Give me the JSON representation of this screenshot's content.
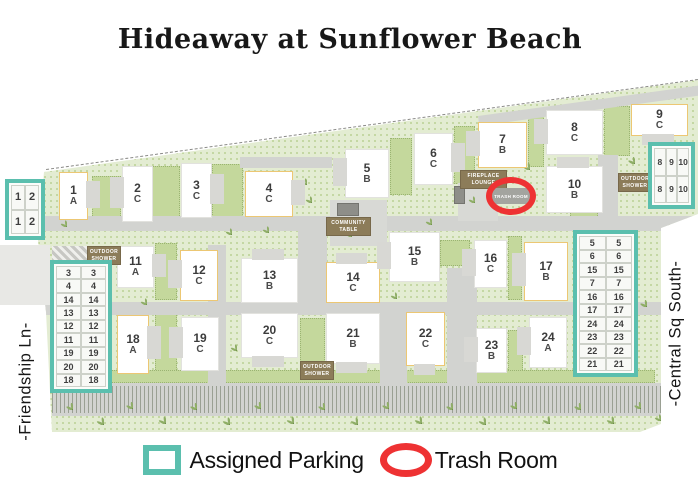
{
  "title": "Hideaway at Sunflower Beach",
  "streets": {
    "left": "-Friendship Ln-",
    "right": "-Central Sq South-"
  },
  "legend": {
    "parking_label": "Assigned Parking",
    "trash_label": "Trash Room"
  },
  "trash_room": {
    "label": "TRASH ROOM"
  },
  "colors": {
    "teal": "#5BBFAE",
    "red": "#EE3233",
    "yellow": "#ECC773",
    "badge": "#8C7C59",
    "road": "#D2D3D0",
    "green": "#E3ECD2"
  },
  "amenities": [
    {
      "id": "fireplace-lounge",
      "lines": [
        "FIREPLACE",
        "LOUNGE"
      ],
      "x": 460,
      "y": 170,
      "w": 47
    },
    {
      "id": "community-table",
      "lines": [
        "COMMUNITY",
        "TABLE"
      ],
      "x": 326,
      "y": 217,
      "w": 45
    },
    {
      "id": "outdoor-shower-nw",
      "lines": [
        "OUTDOOR",
        "SHOWER"
      ],
      "x": 87,
      "y": 246,
      "w": 34
    },
    {
      "id": "outdoor-shower-s",
      "lines": [
        "OUTDOOR",
        "SHOWER"
      ],
      "x": 300,
      "y": 361,
      "w": 34
    },
    {
      "id": "outdoor-shower-ne",
      "lines": [
        "OUTDOOR",
        "SHOWER"
      ],
      "x": 618,
      "y": 173,
      "w": 34
    }
  ],
  "buildings": [
    {
      "n": "1",
      "u": "A",
      "x": 59,
      "y": 172,
      "w": 29,
      "h": 48,
      "yellow": true,
      "wing": "r"
    },
    {
      "n": "2",
      "u": "C",
      "x": 122,
      "y": 166,
      "w": 31,
      "h": 56,
      "yellow": false,
      "wing": "l"
    },
    {
      "n": "3",
      "u": "C",
      "x": 181,
      "y": 163,
      "w": 31,
      "h": 55,
      "yellow": false,
      "wing": "r"
    },
    {
      "n": "4",
      "u": "C",
      "x": 245,
      "y": 171,
      "w": 48,
      "h": 46,
      "yellow": true,
      "wing": "r"
    },
    {
      "n": "5",
      "u": "B",
      "x": 345,
      "y": 149,
      "w": 44,
      "h": 49,
      "yellow": false,
      "wing": "l"
    },
    {
      "n": "6",
      "u": "C",
      "x": 414,
      "y": 133,
      "w": 39,
      "h": 52,
      "yellow": false,
      "wing": "r"
    },
    {
      "n": "7",
      "u": "B",
      "x": 478,
      "y": 122,
      "w": 49,
      "h": 46,
      "yellow": true,
      "wing": "l"
    },
    {
      "n": "8",
      "u": "C",
      "x": 546,
      "y": 110,
      "w": 57,
      "h": 45,
      "yellow": false,
      "wing": "l"
    },
    {
      "n": "9",
      "u": "C",
      "x": 631,
      "y": 104,
      "w": 57,
      "h": 32,
      "yellow": true,
      "wing": "b"
    },
    {
      "n": "10",
      "u": "B",
      "x": 546,
      "y": 166,
      "w": 57,
      "h": 47,
      "yellow": false,
      "wing": "t"
    },
    {
      "n": "11",
      "u": "A",
      "x": 117,
      "y": 246,
      "w": 37,
      "h": 42,
      "yellow": false,
      "wing": "r"
    },
    {
      "n": "12",
      "u": "C",
      "x": 180,
      "y": 250,
      "w": 38,
      "h": 51,
      "yellow": true,
      "wing": "l"
    },
    {
      "n": "13",
      "u": "B",
      "x": 241,
      "y": 258,
      "w": 57,
      "h": 45,
      "yellow": false,
      "wing": "t"
    },
    {
      "n": "14",
      "u": "C",
      "x": 326,
      "y": 262,
      "w": 54,
      "h": 41,
      "yellow": true,
      "wing": "t"
    },
    {
      "n": "15",
      "u": "B",
      "x": 389,
      "y": 232,
      "w": 51,
      "h": 50,
      "yellow": false,
      "wing": "l"
    },
    {
      "n": "16",
      "u": "C",
      "x": 474,
      "y": 240,
      "w": 33,
      "h": 48,
      "yellow": false,
      "wing": "l"
    },
    {
      "n": "17",
      "u": "B",
      "x": 524,
      "y": 242,
      "w": 44,
      "h": 59,
      "yellow": true,
      "wing": "l"
    },
    {
      "n": "18",
      "u": "A",
      "x": 117,
      "y": 315,
      "w": 32,
      "h": 59,
      "yellow": true,
      "wing": "r"
    },
    {
      "n": "19",
      "u": "C",
      "x": 181,
      "y": 317,
      "w": 38,
      "h": 54,
      "yellow": false,
      "wing": "l"
    },
    {
      "n": "20",
      "u": "C",
      "x": 241,
      "y": 313,
      "w": 57,
      "h": 45,
      "yellow": false,
      "wing": "b"
    },
    {
      "n": "21",
      "u": "B",
      "x": 326,
      "y": 313,
      "w": 54,
      "h": 51,
      "yellow": false,
      "wing": "b"
    },
    {
      "n": "22",
      "u": "C",
      "x": 406,
      "y": 312,
      "w": 39,
      "h": 54,
      "yellow": true,
      "wing": "b"
    },
    {
      "n": "23",
      "u": "B",
      "x": 476,
      "y": 328,
      "w": 31,
      "h": 45,
      "yellow": false,
      "wing": "l"
    },
    {
      "n": "24",
      "u": "A",
      "x": 529,
      "y": 317,
      "w": 38,
      "h": 51,
      "yellow": false,
      "wing": "l"
    }
  ],
  "parking_grids": [
    {
      "name": "northwest",
      "cols": 2,
      "fs": 11,
      "rows": [
        [
          "1",
          "2"
        ],
        [
          "1",
          "2"
        ]
      ],
      "x": 5,
      "y": 179,
      "w": 40,
      "h": 61
    },
    {
      "name": "northeast",
      "cols": 3,
      "fs": 8.5,
      "rows": [
        [
          "8",
          "9",
          "10"
        ],
        [
          "8",
          "9",
          "10"
        ]
      ],
      "x": 648,
      "y": 142,
      "w": 47,
      "h": 67
    },
    {
      "name": "west",
      "cols": 2,
      "fs": 9,
      "rows": [
        [
          "3",
          "3"
        ],
        [
          "4",
          "4"
        ],
        [
          "14",
          "14"
        ],
        [
          "13",
          "13"
        ],
        [
          "12",
          "12"
        ],
        [
          "11",
          "11"
        ],
        [
          "19",
          "19"
        ],
        [
          "20",
          "20"
        ],
        [
          "18",
          "18"
        ]
      ],
      "x": 50,
      "y": 260,
      "w": 62,
      "h": 133
    },
    {
      "name": "east",
      "cols": 2,
      "fs": 9,
      "rows": [
        [
          "5",
          "5"
        ],
        [
          "6",
          "6"
        ],
        [
          "15",
          "15"
        ],
        [
          "7",
          "7"
        ],
        [
          "16",
          "16"
        ],
        [
          "17",
          "17"
        ],
        [
          "24",
          "24"
        ],
        [
          "23",
          "23"
        ],
        [
          "22",
          "22"
        ],
        [
          "21",
          "21"
        ]
      ],
      "x": 573,
      "y": 230,
      "w": 65,
      "h": 147
    }
  ],
  "decor": {
    "roads": [
      {
        "x": 0,
        "y": 245,
        "w": 50,
        "h": 60,
        "v": "lot",
        "unclipped": true
      },
      {
        "x": 45,
        "y": 216,
        "w": 650,
        "h": 15
      },
      {
        "x": 40,
        "y": 302,
        "w": 621,
        "h": 13
      },
      {
        "x": 240,
        "y": 157,
        "w": 92,
        "h": 11
      },
      {
        "x": 298,
        "y": 227,
        "w": 29,
        "h": 80
      },
      {
        "x": 208,
        "y": 245,
        "w": 18,
        "h": 57
      },
      {
        "x": 208,
        "y": 315,
        "w": 18,
        "h": 72
      },
      {
        "x": 380,
        "y": 313,
        "w": 27,
        "h": 72
      },
      {
        "x": 447,
        "y": 268,
        "w": 30,
        "h": 117
      },
      {
        "x": 598,
        "y": 155,
        "w": 20,
        "h": 64
      },
      {
        "x": 478,
        "y": 116,
        "w": 225,
        "h": 10,
        "rot": -7.86
      },
      {
        "x": 330,
        "y": 200,
        "w": 57,
        "h": 46,
        "v": "plaza"
      },
      {
        "x": 458,
        "y": 183,
        "w": 40,
        "h": 38,
        "v": "plaza"
      },
      {
        "x": 52,
        "y": 383,
        "w": 609,
        "h": 33
      },
      {
        "x": 52,
        "y": 386,
        "w": 609,
        "h": 27,
        "v": "stripes"
      },
      {
        "x": 52,
        "y": 246,
        "w": 36,
        "h": 16,
        "v": "hatch"
      },
      {
        "x": 337,
        "y": 203,
        "w": 22,
        "h": 13,
        "v": "furniture"
      },
      {
        "x": 454,
        "y": 186,
        "w": 11,
        "h": 18,
        "v": "furniture"
      }
    ],
    "gardens": [
      {
        "x": 92,
        "y": 176,
        "w": 29,
        "h": 48
      },
      {
        "x": 152,
        "y": 166,
        "w": 28,
        "h": 54
      },
      {
        "x": 212,
        "y": 164,
        "w": 31,
        "h": 55
      },
      {
        "x": 390,
        "y": 138,
        "w": 22,
        "h": 57
      },
      {
        "x": 454,
        "y": 126,
        "w": 21,
        "h": 58
      },
      {
        "x": 528,
        "y": 112,
        "w": 16,
        "h": 55
      },
      {
        "x": 604,
        "y": 106,
        "w": 26,
        "h": 50
      },
      {
        "x": 155,
        "y": 243,
        "w": 22,
        "h": 57
      },
      {
        "x": 155,
        "y": 312,
        "w": 22,
        "h": 62
      },
      {
        "x": 300,
        "y": 250,
        "w": 25,
        "h": 50
      },
      {
        "x": 440,
        "y": 240,
        "w": 30,
        "h": 26
      },
      {
        "x": 508,
        "y": 236,
        "w": 14,
        "h": 64
      },
      {
        "x": 300,
        "y": 318,
        "w": 25,
        "h": 52
      },
      {
        "x": 508,
        "y": 330,
        "w": 15,
        "h": 44
      },
      {
        "x": 55,
        "y": 370,
        "w": 600,
        "h": 13
      },
      {
        "x": 570,
        "y": 212,
        "w": 28,
        "h": 16
      }
    ],
    "palms": [
      [
        66,
        403,
        14
      ],
      [
        96,
        417,
        15
      ],
      [
        126,
        402,
        14
      ],
      [
        158,
        416,
        15
      ],
      [
        190,
        403,
        14
      ],
      [
        222,
        417,
        15
      ],
      [
        254,
        402,
        14
      ],
      [
        286,
        416,
        15
      ],
      [
        318,
        403,
        14
      ],
      [
        350,
        417,
        15
      ],
      [
        382,
        402,
        14
      ],
      [
        414,
        416,
        15
      ],
      [
        446,
        403,
        14
      ],
      [
        478,
        417,
        15
      ],
      [
        510,
        402,
        14
      ],
      [
        542,
        416,
        15
      ],
      [
        574,
        403,
        14
      ],
      [
        606,
        416,
        15
      ],
      [
        634,
        402,
        14
      ],
      [
        654,
        414,
        13
      ],
      [
        225,
        228,
        13
      ],
      [
        262,
        226,
        13
      ],
      [
        305,
        196,
        13
      ],
      [
        345,
        230,
        13
      ],
      [
        425,
        218,
        13
      ],
      [
        468,
        196,
        13
      ],
      [
        523,
        163,
        14
      ],
      [
        588,
        234,
        14
      ],
      [
        628,
        157,
        14
      ],
      [
        664,
        128,
        14
      ],
      [
        670,
        196,
        13
      ],
      [
        57,
        312,
        13
      ],
      [
        140,
        298,
        13
      ],
      [
        230,
        344,
        13
      ],
      [
        390,
        292,
        13
      ],
      [
        560,
        332,
        14
      ],
      [
        640,
        300,
        14
      ],
      [
        60,
        220,
        13
      ],
      [
        360,
        156,
        13
      ],
      [
        300,
        178,
        13
      ]
    ]
  }
}
